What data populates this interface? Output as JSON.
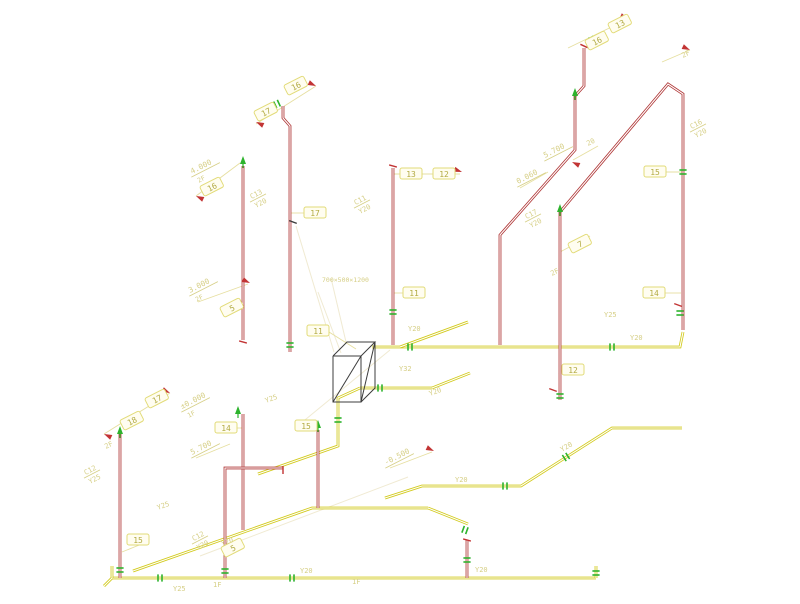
{
  "drawing": {
    "kind": "axonometric-piping-diagram",
    "palette": {
      "background": "#ffffff",
      "pipe_yellow": "#d2ca1c",
      "pipe_red": "#b03838",
      "leader": "#e6dfa0",
      "faint": "#f0ead2",
      "pale_text": "#d6cf86",
      "olive_text": "#b2aa42",
      "box_fill": "#fffdf0",
      "box_stroke": "#e2db78",
      "valve_green": "#2db32d",
      "arrow_red": "#c23434",
      "equipment": "#3c3c3c"
    },
    "yellow_pipes": [
      [
        [
          112,
          578
        ],
        [
          596,
          578
        ]
      ],
      [
        [
          112,
          566
        ],
        [
          112,
          578
        ]
      ],
      [
        [
          104,
          586
        ],
        [
          112,
          578
        ]
      ],
      [
        [
          133,
          571
        ],
        [
          312,
          508
        ],
        [
          428,
          508
        ]
      ],
      [
        [
          428,
          508
        ],
        [
          468,
          524
        ]
      ],
      [
        [
          385,
          498
        ],
        [
          422,
          486
        ],
        [
          521,
          486
        ],
        [
          612,
          428
        ],
        [
          682,
          428
        ]
      ],
      [
        [
          372,
          347
        ],
        [
          680,
          347
        ],
        [
          683,
          332
        ]
      ],
      [
        [
          360,
          388
        ],
        [
          432,
          388
        ]
      ],
      [
        [
          432,
          388
        ],
        [
          470,
          373
        ]
      ],
      [
        [
          360,
          388
        ],
        [
          338,
          398
        ],
        [
          338,
          446
        ],
        [
          258,
          474
        ]
      ],
      [
        [
          400,
          347
        ],
        [
          468,
          322
        ]
      ],
      [
        [
          596,
          566
        ],
        [
          596,
          578
        ]
      ]
    ],
    "red_pipes": [
      [
        [
          283,
          106
        ],
        [
          283,
          118
        ],
        [
          290,
          126
        ],
        [
          290,
          352
        ]
      ],
      [
        [
          243,
          166
        ],
        [
          243,
          340
        ]
      ],
      [
        [
          243,
          414
        ],
        [
          243,
          530
        ]
      ],
      [
        [
          120,
          434
        ],
        [
          120,
          578
        ]
      ],
      [
        [
          225,
          578
        ],
        [
          225,
          468
        ],
        [
          283,
          468
        ]
      ],
      [
        [
          393,
          168
        ],
        [
          393,
          345
        ]
      ],
      [
        [
          318,
          430
        ],
        [
          318,
          508
        ]
      ],
      [
        [
          560,
          212
        ],
        [
          560,
          400
        ]
      ],
      [
        [
          500,
          345
        ],
        [
          500,
          235
        ],
        [
          575,
          150
        ],
        [
          575,
          96
        ]
      ],
      [
        [
          575,
          96
        ],
        [
          584,
          86
        ],
        [
          584,
          48
        ]
      ],
      [
        [
          560,
          212
        ],
        [
          668,
          84
        ],
        [
          683,
          94
        ],
        [
          683,
          330
        ]
      ],
      [
        [
          467,
          540
        ],
        [
          467,
          578
        ]
      ]
    ],
    "faint_lines": [
      [
        [
          296,
          226
        ],
        [
          334,
          352
        ]
      ],
      [
        [
          318,
          292
        ],
        [
          341,
          353
        ]
      ],
      [
        [
          331,
          278
        ],
        [
          346,
          342
        ]
      ],
      [
        [
          200,
          556
        ],
        [
          408,
          477
        ]
      ],
      [
        [
          390,
          350
        ],
        [
          300,
          424
        ]
      ]
    ],
    "leaders": [
      [
        [
          256,
          124
        ],
        [
          316,
          86
        ]
      ],
      [
        [
          196,
          196
        ],
        [
          240,
          163
        ]
      ],
      [
        [
          104,
          434
        ],
        [
          170,
          393
        ]
      ],
      [
        [
          568,
          48
        ],
        [
          626,
          20
        ]
      ],
      [
        [
          662,
          62
        ],
        [
          690,
          50
        ]
      ],
      [
        [
          560,
          252
        ],
        [
          590,
          236
        ]
      ],
      [
        [
          198,
          302
        ],
        [
          248,
          284
        ]
      ],
      [
        [
          573,
          160
        ],
        [
          598,
          146
        ]
      ],
      [
        [
          390,
          468
        ],
        [
          432,
          452
        ]
      ],
      [
        [
          393,
          174
        ],
        [
          460,
          174
        ]
      ],
      [
        [
          666,
          172
        ],
        [
          683,
          172
        ]
      ],
      [
        [
          665,
          293
        ],
        [
          681,
          293
        ]
      ],
      [
        [
          404,
          293
        ],
        [
          394,
          293
        ]
      ],
      [
        [
          329,
          332
        ],
        [
          356,
          349
        ]
      ],
      [
        [
          304,
          213
        ],
        [
          291,
          213
        ]
      ],
      [
        [
          237,
          428
        ],
        [
          242,
          428
        ]
      ],
      [
        [
          317,
          428
        ],
        [
          318,
          433
        ]
      ],
      [
        [
          149,
          541
        ],
        [
          122,
          552
        ]
      ],
      [
        [
          562,
          370
        ],
        [
          559,
          374
        ]
      ],
      [
        [
          196,
          458
        ],
        [
          230,
          444
        ]
      ],
      [
        [
          520,
          188
        ],
        [
          548,
          172
        ]
      ]
    ],
    "valves": [
      {
        "x": 680,
        "y": 313,
        "rot": 90
      },
      {
        "x": 290,
        "y": 345,
        "rot": 90
      },
      {
        "x": 225,
        "y": 571,
        "rot": 90
      },
      {
        "x": 120,
        "y": 570,
        "rot": 90
      },
      {
        "x": 292,
        "y": 578,
        "rot": 0
      },
      {
        "x": 160,
        "y": 578,
        "rot": 0
      },
      {
        "x": 465,
        "y": 530,
        "rot": 20
      },
      {
        "x": 505,
        "y": 486,
        "rot": 0
      },
      {
        "x": 566,
        "y": 457,
        "rot": -32
      },
      {
        "x": 380,
        "y": 388,
        "rot": 0
      },
      {
        "x": 410,
        "y": 347,
        "rot": 0
      },
      {
        "x": 560,
        "y": 396,
        "rot": 90
      },
      {
        "x": 467,
        "y": 560,
        "rot": 90
      },
      {
        "x": 596,
        "y": 573,
        "rot": 90
      },
      {
        "x": 277,
        "y": 104,
        "rot": -25
      },
      {
        "x": 592,
        "y": 40,
        "rot": -25
      },
      {
        "x": 683,
        "y": 172,
        "rot": 90
      },
      {
        "x": 393,
        "y": 312,
        "rot": 90
      },
      {
        "x": 338,
        "y": 420,
        "rot": 90
      },
      {
        "x": 612,
        "y": 347,
        "rot": 0
      }
    ],
    "green_arrows": [
      {
        "x": 243,
        "y": 158
      },
      {
        "x": 120,
        "y": 428
      },
      {
        "x": 238,
        "y": 408
      },
      {
        "x": 318,
        "y": 422
      },
      {
        "x": 575,
        "y": 90
      },
      {
        "x": 560,
        "y": 206
      }
    ],
    "red_arrows": [
      {
        "x": 256,
        "y": 122,
        "ang": 205
      },
      {
        "x": 316,
        "y": 86,
        "ang": 25
      },
      {
        "x": 196,
        "y": 196,
        "ang": 205
      },
      {
        "x": 462,
        "y": 172,
        "ang": 20
      },
      {
        "x": 572,
        "y": 162,
        "ang": 205
      },
      {
        "x": 628,
        "y": 19,
        "ang": 25
      },
      {
        "x": 690,
        "y": 50,
        "ang": 25
      },
      {
        "x": 104,
        "y": 434,
        "ang": 205
      },
      {
        "x": 170,
        "y": 393,
        "ang": 25
      },
      {
        "x": 434,
        "y": 451,
        "ang": 25
      },
      {
        "x": 250,
        "y": 283,
        "ang": 25
      }
    ],
    "ticks": [
      {
        "x": 293,
        "y": 222,
        "rot": 20,
        "c": "#3c3c3c"
      },
      {
        "x": 678,
        "y": 305,
        "rot": 20,
        "c": "#c23434"
      },
      {
        "x": 553,
        "y": 390,
        "rot": 20,
        "c": "#c23434"
      },
      {
        "x": 584,
        "y": 46,
        "rot": 25,
        "c": "#c23434"
      },
      {
        "x": 393,
        "y": 166,
        "rot": 15,
        "c": "#c23434"
      },
      {
        "x": 243,
        "y": 342,
        "rot": 15,
        "c": "#c23434"
      },
      {
        "x": 283,
        "y": 470,
        "rot": 90,
        "c": "#c23434"
      },
      {
        "x": 467,
        "y": 540,
        "rot": 15,
        "c": "#c23434"
      }
    ],
    "number_boxes": [
      {
        "label": "17",
        "x": 266,
        "y": 112,
        "rot": -27
      },
      {
        "label": "16",
        "x": 296,
        "y": 86,
        "rot": -27
      },
      {
        "label": "17",
        "x": 315,
        "y": 213,
        "rot": 0
      },
      {
        "label": "16",
        "x": 212,
        "y": 187,
        "rot": -27
      },
      {
        "label": "13",
        "x": 411,
        "y": 174,
        "rot": 0
      },
      {
        "label": "12",
        "x": 444,
        "y": 174,
        "rot": 0
      },
      {
        "label": "11",
        "x": 414,
        "y": 293,
        "rot": 0
      },
      {
        "label": "11",
        "x": 318,
        "y": 331,
        "rot": 0
      },
      {
        "label": "15",
        "x": 655,
        "y": 172,
        "rot": 0
      },
      {
        "label": "14",
        "x": 654,
        "y": 293,
        "rot": 0
      },
      {
        "label": "7",
        "x": 580,
        "y": 244,
        "rot": -27
      },
      {
        "label": "12",
        "x": 573,
        "y": 370,
        "rot": 0
      },
      {
        "label": "14",
        "x": 226,
        "y": 428,
        "rot": 0
      },
      {
        "label": "18",
        "x": 132,
        "y": 421,
        "rot": -27
      },
      {
        "label": "17",
        "x": 157,
        "y": 399,
        "rot": -27
      },
      {
        "label": "15",
        "x": 138,
        "y": 540,
        "rot": 0
      },
      {
        "label": "5",
        "x": 233,
        "y": 548,
        "rot": -27
      },
      {
        "label": "5",
        "x": 232,
        "y": 308,
        "rot": -27
      },
      {
        "label": "15",
        "x": 306,
        "y": 426,
        "rot": 0
      },
      {
        "label": "16",
        "x": 597,
        "y": 41,
        "rot": -27
      },
      {
        "label": "13",
        "x": 620,
        "y": 24,
        "rot": -27
      }
    ],
    "riser_tags": [
      {
        "top": "C13",
        "bottom": "Y20",
        "x": 258,
        "y": 198,
        "rot": -27
      },
      {
        "top": "C11",
        "bottom": "Y20",
        "x": 362,
        "y": 204,
        "rot": -27
      },
      {
        "top": "C17",
        "bottom": "Y20",
        "x": 533,
        "y": 218,
        "rot": -27
      },
      {
        "top": "C16",
        "bottom": "Y20",
        "x": 698,
        "y": 128,
        "rot": -27
      },
      {
        "top": "C12",
        "bottom": "Y20",
        "x": 200,
        "y": 540,
        "rot": -27
      },
      {
        "top": "C12",
        "bottom": "Y25",
        "x": 92,
        "y": 474,
        "rot": -27
      }
    ],
    "elevations": [
      {
        "value": "4.000",
        "sub": "2F",
        "x": 192,
        "y": 174,
        "rot": -27
      },
      {
        "value": "3.000",
        "sub": "2F",
        "x": 190,
        "y": 293,
        "rot": -27
      },
      {
        "value": "±0.000",
        "sub": "1F",
        "x": 182,
        "y": 409,
        "rot": -27
      },
      {
        "value": "5.700",
        "sub": "",
        "x": 192,
        "y": 455,
        "rot": -27
      },
      {
        "value": "5.700",
        "sub": "",
        "x": 545,
        "y": 158,
        "rot": -27
      },
      {
        "value": "0.060",
        "sub": "",
        "x": 518,
        "y": 184,
        "rot": -27
      },
      {
        "value": "-0.500",
        "sub": "",
        "x": 386,
        "y": 465,
        "rot": -27
      }
    ],
    "pipe_labels": [
      {
        "text": "Y25",
        "x": 158,
        "y": 510,
        "rot": -20
      },
      {
        "text": "Y25",
        "x": 173,
        "y": 591,
        "rot": 0
      },
      {
        "text": "Y20",
        "x": 300,
        "y": 573,
        "rot": 0
      },
      {
        "text": "Y20",
        "x": 475,
        "y": 572,
        "rot": 0
      },
      {
        "text": "Y25",
        "x": 266,
        "y": 403,
        "rot": -20
      },
      {
        "text": "Y20",
        "x": 408,
        "y": 331,
        "rot": 0
      },
      {
        "text": "Y25",
        "x": 604,
        "y": 317,
        "rot": 0
      },
      {
        "text": "Y20",
        "x": 455,
        "y": 482,
        "rot": 0
      },
      {
        "text": "Y20",
        "x": 562,
        "y": 452,
        "rot": -30
      },
      {
        "text": "Y32",
        "x": 399,
        "y": 371,
        "rot": 0
      },
      {
        "text": "Y20",
        "x": 430,
        "y": 396,
        "rot": -20
      },
      {
        "text": "Y20",
        "x": 222,
        "y": 546,
        "rot": -20
      },
      {
        "text": "Y20",
        "x": 630,
        "y": 340,
        "rot": 0
      },
      {
        "text": "20",
        "x": 588,
        "y": 146,
        "rot": -27
      }
    ],
    "floor_marks": [
      {
        "text": "2F",
        "x": 106,
        "y": 449,
        "rot": -27
      },
      {
        "text": "2F",
        "x": 552,
        "y": 276,
        "rot": -27
      },
      {
        "text": "2F",
        "x": 683,
        "y": 58,
        "rot": -27
      },
      {
        "text": "1F",
        "x": 213,
        "y": 587,
        "rot": 0
      },
      {
        "text": "1F",
        "x": 352,
        "y": 584,
        "rot": 0
      }
    ],
    "equipment": {
      "note": "700×500×1200",
      "note_x": 322,
      "note_y": 282,
      "lines": [
        [
          [
            333,
            356
          ],
          [
            361,
            356
          ],
          [
            361,
            402
          ],
          [
            333,
            402
          ],
          [
            333,
            356
          ]
        ],
        [
          [
            333,
            356
          ],
          [
            347,
            342
          ],
          [
            375,
            342
          ],
          [
            361,
            356
          ]
        ],
        [
          [
            375,
            342
          ],
          [
            375,
            388
          ],
          [
            361,
            402
          ]
        ],
        [
          [
            333,
            402
          ],
          [
            361,
            356
          ]
        ],
        [
          [
            361,
            402
          ],
          [
            375,
            342
          ]
        ]
      ]
    }
  }
}
